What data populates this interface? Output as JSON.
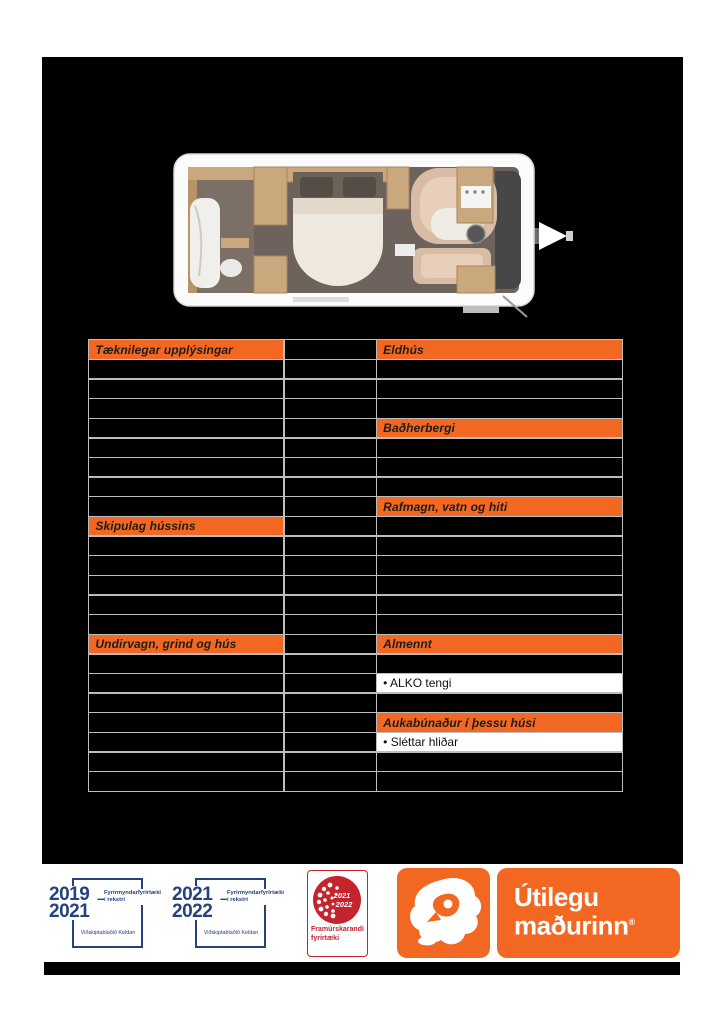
{
  "colors": {
    "accent": "#F26722",
    "blue": "#24427C",
    "red": "#C5242C",
    "border": "#BDBDBD",
    "canvas_bg": "#000000",
    "page_bg": "#FFFFFF"
  },
  "table": {
    "left_rows": [
      {
        "type": "header",
        "label": "Tæknilegar upplýsingar"
      },
      {
        "type": "empty",
        "label": ""
      },
      {
        "type": "empty",
        "label": ""
      },
      {
        "type": "empty",
        "label": ""
      },
      {
        "type": "empty",
        "label": ""
      },
      {
        "type": "empty",
        "label": ""
      },
      {
        "type": "empty",
        "label": ""
      },
      {
        "type": "empty",
        "label": ""
      },
      {
        "type": "empty",
        "label": ""
      },
      {
        "type": "header",
        "label": "Skipulag hússins"
      },
      {
        "type": "empty",
        "label": ""
      },
      {
        "type": "empty",
        "label": ""
      },
      {
        "type": "empty",
        "label": ""
      },
      {
        "type": "empty",
        "label": ""
      },
      {
        "type": "empty",
        "label": ""
      },
      {
        "type": "header",
        "label": "Undirvagn, grind og hús"
      },
      {
        "type": "empty",
        "label": ""
      },
      {
        "type": "empty",
        "label": ""
      },
      {
        "type": "empty",
        "label": ""
      },
      {
        "type": "empty",
        "label": ""
      },
      {
        "type": "empty",
        "label": ""
      },
      {
        "type": "empty",
        "label": ""
      },
      {
        "type": "empty",
        "label": ""
      }
    ],
    "right_rows": [
      {
        "type": "header",
        "label": "Eldhús"
      },
      {
        "type": "empty",
        "label": ""
      },
      {
        "type": "empty",
        "label": ""
      },
      {
        "type": "empty",
        "label": ""
      },
      {
        "type": "header",
        "label": "Baðherbergi"
      },
      {
        "type": "empty",
        "label": ""
      },
      {
        "type": "empty",
        "label": ""
      },
      {
        "type": "empty",
        "label": ""
      },
      {
        "type": "header",
        "label": "Rafmagn, vatn og hiti"
      },
      {
        "type": "empty",
        "label": ""
      },
      {
        "type": "empty",
        "label": ""
      },
      {
        "type": "empty",
        "label": ""
      },
      {
        "type": "empty",
        "label": ""
      },
      {
        "type": "empty",
        "label": ""
      },
      {
        "type": "empty",
        "label": ""
      },
      {
        "type": "header",
        "label": "Almennt"
      },
      {
        "type": "empty",
        "label": ""
      },
      {
        "type": "item",
        "label": "• ALKO tengi"
      },
      {
        "type": "empty",
        "label": ""
      },
      {
        "type": "header",
        "label": "Aukabúnaður í þessu húsi"
      },
      {
        "type": "item",
        "label": "• Sléttar hliðar"
      },
      {
        "type": "empty",
        "label": ""
      },
      {
        "type": "empty",
        "label": ""
      }
    ]
  },
  "footer": {
    "badge_2019_2021": {
      "year_top": "2019",
      "year_bottom": "2021",
      "dash": "–",
      "title_line1": "Fyrirmyndarfyrirtæki",
      "title_line2": "í rekstri",
      "subtitle": "Viðskiptablaðið Keldan"
    },
    "badge_2021_2022": {
      "year_top": "2021",
      "year_bottom": "2022",
      "dash": "–",
      "title_line1": "Fyrirmyndarfyrirtæki",
      "title_line2": "í rekstri",
      "subtitle": "Viðskiptablaðið Keldan"
    },
    "badge_framurskarandi": {
      "year_top": "2021",
      "year_bottom": "2022",
      "caption_line1": "Framúrskarandi",
      "caption_line2": "fyrirtæki"
    },
    "brand": {
      "line1": "Útilegu",
      "line2": "maðurinn",
      "reg": "®"
    }
  }
}
